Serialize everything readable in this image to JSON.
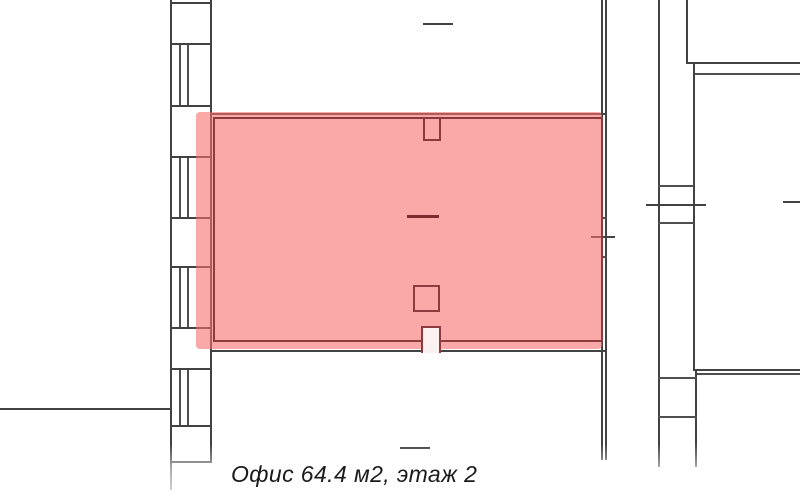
{
  "caption": {
    "text": "Офис 64.4 м2, этаж 2"
  },
  "highlighted_room": {
    "type": "Офис",
    "area": "64.4 м2",
    "floor": "этаж 2"
  },
  "colors": {
    "wall": "#424242",
    "wall_thin": "#4f4f4f",
    "wall_light": "#6e6e6e",
    "hl_fill": "rgba(247,110,110,0.60)",
    "hl_border": "#8e3a3e",
    "hl_dash": "#7c2b31",
    "stub_bg": "#fdf0f0",
    "text": "#1b1b1b"
  },
  "plan": {
    "elements": [
      {
        "n": "left-axis-tick-line",
        "x": 0,
        "y": 408,
        "w": 170,
        "h": 2,
        "c": "wall"
      },
      {
        "n": "left-wall-outer-edge",
        "x": 170,
        "y": 0,
        "w": 2,
        "h": 490,
        "c": "wall"
      },
      {
        "n": "left-wall-inner-edge",
        "x": 210,
        "y": 0,
        "w": 2,
        "h": 463,
        "c": "wall"
      },
      {
        "n": "left-wall-division",
        "x": 170,
        "y": 2,
        "w": 42,
        "h": 2,
        "c": "wall"
      },
      {
        "n": "left-wall-division",
        "x": 170,
        "y": 43,
        "w": 42,
        "h": 2,
        "c": "wall"
      },
      {
        "n": "left-wall-division",
        "x": 170,
        "y": 105,
        "w": 42,
        "h": 2,
        "c": "wall"
      },
      {
        "n": "left-wall-division",
        "x": 170,
        "y": 156,
        "w": 42,
        "h": 2,
        "c": "wall"
      },
      {
        "n": "left-wall-division",
        "x": 170,
        "y": 217,
        "w": 42,
        "h": 2,
        "c": "wall"
      },
      {
        "n": "left-wall-division",
        "x": 170,
        "y": 266,
        "w": 42,
        "h": 2,
        "c": "wall"
      },
      {
        "n": "left-wall-division",
        "x": 170,
        "y": 327,
        "w": 42,
        "h": 2,
        "c": "wall"
      },
      {
        "n": "left-wall-division",
        "x": 170,
        "y": 368,
        "w": 42,
        "h": 2,
        "c": "wall"
      },
      {
        "n": "left-wall-division",
        "x": 170,
        "y": 425,
        "w": 42,
        "h": 2,
        "c": "wall"
      },
      {
        "n": "left-wall-division",
        "x": 170,
        "y": 461,
        "w": 42,
        "h": 2,
        "c": "wall"
      },
      {
        "n": "window-glazing-line",
        "x": 179,
        "y": 45,
        "w": 1.5,
        "h": 60,
        "c": "wall_thin"
      },
      {
        "n": "window-glazing-line",
        "x": 187,
        "y": 45,
        "w": 1.5,
        "h": 60,
        "c": "wall_thin"
      },
      {
        "n": "window-glazing-line",
        "x": 179,
        "y": 158,
        "w": 1.5,
        "h": 59,
        "c": "wall_thin"
      },
      {
        "n": "window-glazing-line",
        "x": 187,
        "y": 158,
        "w": 1.5,
        "h": 59,
        "c": "wall_thin"
      },
      {
        "n": "window-glazing-line",
        "x": 179,
        "y": 268,
        "w": 1.5,
        "h": 59,
        "c": "wall_thin"
      },
      {
        "n": "window-glazing-line",
        "x": 187,
        "y": 268,
        "w": 1.5,
        "h": 59,
        "c": "wall_thin"
      },
      {
        "n": "window-glazing-line",
        "x": 179,
        "y": 370,
        "w": 1.5,
        "h": 55,
        "c": "wall_thin"
      },
      {
        "n": "window-glazing-line",
        "x": 187,
        "y": 370,
        "w": 1.5,
        "h": 55,
        "c": "wall_thin"
      },
      {
        "n": "office-top-wall",
        "x": 211,
        "y": 113,
        "w": 395,
        "h": 2,
        "c": "wall"
      },
      {
        "n": "office-bottom-wall-left",
        "x": 211,
        "y": 350,
        "w": 211,
        "h": 2,
        "c": "wall"
      },
      {
        "n": "office-bottom-wall-right",
        "x": 441,
        "y": 350,
        "w": 165,
        "h": 2,
        "c": "wall"
      },
      {
        "n": "right-wall-inner-line",
        "x": 601,
        "y": 0,
        "w": 1.5,
        "h": 460,
        "c": "wall"
      },
      {
        "n": "right-wall-outer-line",
        "x": 605,
        "y": 0,
        "w": 1.5,
        "h": 460,
        "c": "wall"
      },
      {
        "n": "right-wall-rung",
        "x": 601,
        "y": 217,
        "w": 6,
        "h": 1.5,
        "c": "wall_thin"
      },
      {
        "n": "right-wall-rung",
        "x": 601,
        "y": 256,
        "w": 6,
        "h": 1.5,
        "c": "wall_thin"
      },
      {
        "n": "right-wall-axis-tick",
        "x": 591,
        "y": 236,
        "w": 24,
        "h": 2,
        "c": "wall"
      },
      {
        "n": "upper-room-door-dash",
        "x": 423,
        "y": 23,
        "w": 30,
        "h": 2,
        "c": "wall"
      },
      {
        "n": "lower-room-door-dash",
        "x": 400,
        "y": 447,
        "w": 30,
        "h": 2,
        "c": "wall"
      },
      {
        "n": "office-highlight-fill",
        "x": 196,
        "y": 112,
        "w": 406,
        "h": 237,
        "c": "hl_fill",
        "r": 4,
        "z": 2,
        "i": true
      },
      {
        "n": "office-highlight-border",
        "x": 213,
        "y": 117,
        "w": 390,
        "h": 225,
        "bd": {
          "c": "hl_border",
          "w": 2.5
        },
        "z": 3
      },
      {
        "n": "office-top-door-stub",
        "x": 423,
        "y": 117,
        "w": 18,
        "h": 24,
        "bd": {
          "c": "hl_border",
          "w": 2.5,
          "sides": [
            "left",
            "right",
            "bottom"
          ]
        },
        "z": 4
      },
      {
        "n": "office-bottom-door-stub",
        "x": 421,
        "y": 326,
        "w": 20,
        "h": 27,
        "c": "stub_bg",
        "bd": {
          "c": "hl_border",
          "w": 2.5,
          "sides": [
            "left",
            "top",
            "right"
          ]
        },
        "z": 4
      },
      {
        "n": "office-column-square",
        "x": 413,
        "y": 285,
        "w": 27,
        "h": 27,
        "bd": {
          "c": "hl_border",
          "w": 2.5
        },
        "z": 4
      },
      {
        "n": "office-center-dash",
        "x": 407,
        "y": 215,
        "w": 32,
        "h": 2.5,
        "c": "hl_dash",
        "z": 4
      },
      {
        "n": "right-wing-wall-v1",
        "x": 658,
        "y": 0,
        "w": 1.5,
        "h": 467,
        "c": "wall"
      },
      {
        "n": "right-wing-wall-v2",
        "x": 686,
        "y": 0,
        "w": 1.5,
        "h": 63,
        "c": "wall"
      },
      {
        "n": "right-wing-top-wall",
        "x": 686,
        "y": 62,
        "w": 114,
        "h": 2,
        "c": "wall"
      },
      {
        "n": "right-wing-top-wall-inner",
        "x": 693,
        "y": 73,
        "w": 107,
        "h": 1.5,
        "c": "wall_thin"
      },
      {
        "n": "right-wing-wall-v3",
        "x": 693,
        "y": 62,
        "w": 1.5,
        "h": 308,
        "c": "wall"
      },
      {
        "n": "right-wing-rung",
        "x": 658,
        "y": 185,
        "w": 36,
        "h": 1.5,
        "c": "wall_thin"
      },
      {
        "n": "right-wing-rung",
        "x": 658,
        "y": 222,
        "w": 36,
        "h": 1.5,
        "c": "wall_thin"
      },
      {
        "n": "right-wing-axis-tick",
        "x": 646,
        "y": 204,
        "w": 60,
        "h": 2,
        "c": "wall"
      },
      {
        "n": "right-edge-axis-dash",
        "x": 783,
        "y": 201,
        "w": 17,
        "h": 1.5,
        "c": "wall"
      },
      {
        "n": "right-wing-mid-wall",
        "x": 693,
        "y": 369,
        "w": 107,
        "h": 2,
        "c": "wall"
      },
      {
        "n": "right-wing-mid-wall-inner",
        "x": 695,
        "y": 373,
        "w": 105,
        "h": 1.5,
        "c": "wall_thin"
      },
      {
        "n": "right-wing-wall-v4",
        "x": 695,
        "y": 369,
        "w": 1.5,
        "h": 98,
        "c": "wall"
      },
      {
        "n": "right-wing-rung",
        "x": 658,
        "y": 377,
        "w": 38.5,
        "h": 1.5,
        "c": "wall_thin"
      },
      {
        "n": "right-wing-rung",
        "x": 658,
        "y": 416,
        "w": 38.5,
        "h": 1.5,
        "c": "wall_thin"
      }
    ]
  }
}
